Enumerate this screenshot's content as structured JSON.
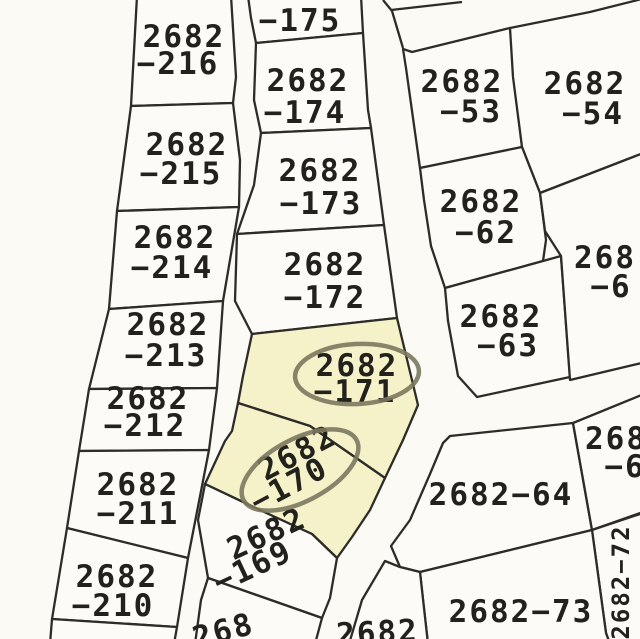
{
  "map": {
    "title": "cadastral-parcel-map",
    "canvas": {
      "width": 640,
      "height": 639
    },
    "colors": {
      "paper": "#fbfaf5",
      "parcel_fill": "#fcfbf7",
      "highlight_fill": "#f5f2ca",
      "line_color": "#2d2c26",
      "text_color": "#22211c",
      "ellipse_color": "#7b785e"
    },
    "style": {
      "line_width": 2.3,
      "font_size": 31,
      "ellipse_width": 4.5
    },
    "parcels": [
      {
        "id": "2682-216",
        "highlight": false,
        "points": [
          [
            137,
            -4
          ],
          [
            231,
            -4
          ],
          [
            236,
            77
          ],
          [
            233,
            103
          ],
          [
            131,
            106
          ]
        ],
        "label": {
          "lines": [
            {
              "t": "2682",
              "x": 184,
              "y": 47,
              "r": 0
            },
            {
              "t": "−216",
              "x": 178,
              "y": 74,
              "r": 0
            }
          ]
        }
      },
      {
        "id": "2682-215",
        "highlight": false,
        "points": [
          [
            131,
            106
          ],
          [
            233,
            103
          ],
          [
            240,
            160
          ],
          [
            239,
            207
          ],
          [
            117,
            211
          ]
        ],
        "label": {
          "lines": [
            {
              "t": "2682",
              "x": 187,
              "y": 155,
              "r": 0
            },
            {
              "t": "−215",
              "x": 181,
              "y": 184,
              "r": 0
            }
          ]
        }
      },
      {
        "id": "2682-214",
        "highlight": false,
        "points": [
          [
            117,
            211
          ],
          [
            239,
            207
          ],
          [
            223,
            301
          ],
          [
            109,
            309
          ]
        ],
        "label": {
          "lines": [
            {
              "t": "2682",
              "x": 175,
              "y": 248,
              "r": 0
            },
            {
              "t": "−214",
              "x": 172,
              "y": 278,
              "r": 0
            }
          ]
        }
      },
      {
        "id": "2682-213",
        "highlight": false,
        "points": [
          [
            109,
            309
          ],
          [
            223,
            301
          ],
          [
            217,
            388
          ],
          [
            89,
            389
          ]
        ],
        "label": {
          "lines": [
            {
              "t": "2682",
              "x": 168,
              "y": 335,
              "r": 0
            },
            {
              "t": "−213",
              "x": 166,
              "y": 366,
              "r": 0
            }
          ]
        }
      },
      {
        "id": "2682-212",
        "highlight": false,
        "points": [
          [
            89,
            389
          ],
          [
            217,
            388
          ],
          [
            209,
            450
          ],
          [
            79,
            451
          ]
        ],
        "label": {
          "lines": [
            {
              "t": "2682",
              "x": 148,
              "y": 409,
              "r": 0
            },
            {
              "t": "−212",
              "x": 145,
              "y": 436,
              "r": 0
            }
          ]
        }
      },
      {
        "id": "2682-211",
        "highlight": false,
        "points": [
          [
            79,
            451
          ],
          [
            209,
            450
          ],
          [
            188,
            558
          ],
          [
            67,
            528
          ]
        ],
        "label": {
          "lines": [
            {
              "t": "2682",
              "x": 138,
              "y": 495,
              "r": 0
            },
            {
              "t": "−211",
              "x": 138,
              "y": 524,
              "r": 0
            }
          ]
        }
      },
      {
        "id": "2682-210",
        "highlight": false,
        "points": [
          [
            67,
            528
          ],
          [
            188,
            558
          ],
          [
            177,
            627
          ],
          [
            52,
            619
          ]
        ],
        "label": {
          "lines": [
            {
              "t": "2682",
              "x": 117,
              "y": 587,
              "r": 0
            },
            {
              "t": "−210",
              "x": 113,
              "y": 616,
              "r": 0
            }
          ]
        }
      },
      {
        "id": "sliver-below-210",
        "highlight": false,
        "points": [
          [
            52,
            619
          ],
          [
            177,
            627
          ],
          [
            174,
            644
          ],
          [
            50,
            644
          ]
        ],
        "label": {
          "lines": []
        }
      },
      {
        "id": "2682-175",
        "highlight": false,
        "points": [
          [
            248,
            -4
          ],
          [
            361,
            -4
          ],
          [
            363,
            33
          ],
          [
            256,
            43
          ],
          [
            251,
            18
          ]
        ],
        "label": {
          "lines": [
            {
              "t": "−175",
              "x": 300,
              "y": 31,
              "r": 0
            }
          ]
        }
      },
      {
        "id": "2682-174",
        "highlight": false,
        "points": [
          [
            256,
            43
          ],
          [
            363,
            33
          ],
          [
            368,
            110
          ],
          [
            371,
            128
          ],
          [
            261,
            133
          ],
          [
            254,
            100
          ]
        ],
        "label": {
          "lines": [
            {
              "t": "2682",
              "x": 308,
              "y": 91,
              "r": 0
            },
            {
              "t": "−174",
              "x": 305,
              "y": 123,
              "r": 0
            }
          ]
        }
      },
      {
        "id": "2682-173",
        "highlight": false,
        "points": [
          [
            261,
            133
          ],
          [
            371,
            128
          ],
          [
            384,
            225
          ],
          [
            237,
            234
          ],
          [
            254,
            185
          ]
        ],
        "label": {
          "lines": [
            {
              "t": "2682",
              "x": 320,
              "y": 181,
              "r": 0
            },
            {
              "t": "−173",
              "x": 321,
              "y": 214,
              "r": 0
            }
          ]
        }
      },
      {
        "id": "2682-172",
        "highlight": false,
        "points": [
          [
            237,
            234
          ],
          [
            384,
            225
          ],
          [
            397,
            318
          ],
          [
            252,
            334
          ],
          [
            235,
            301
          ]
        ],
        "label": {
          "lines": [
            {
              "t": "2682",
              "x": 325,
              "y": 275,
              "r": 0
            },
            {
              "t": "−172",
              "x": 325,
              "y": 308,
              "r": 0
            }
          ]
        }
      },
      {
        "id": "2682-171",
        "highlight": true,
        "points": [
          [
            252,
            334
          ],
          [
            397,
            318
          ],
          [
            418,
            405
          ],
          [
            403,
            440
          ],
          [
            385,
            478
          ],
          [
            310,
            426
          ],
          [
            238,
            403
          ],
          [
            243,
            376
          ]
        ],
        "label": {
          "lines": [
            {
              "t": "2682",
              "x": 357,
              "y": 376,
              "r": 0
            },
            {
              "t": "−171",
              "x": 355,
              "y": 402,
              "r": 0
            }
          ]
        }
      },
      {
        "id": "2682-170",
        "highlight": true,
        "points": [
          [
            238,
            403
          ],
          [
            310,
            426
          ],
          [
            385,
            478
          ],
          [
            370,
            510
          ],
          [
            352,
            537
          ],
          [
            337,
            558
          ],
          [
            312,
            534
          ],
          [
            262,
            511
          ],
          [
            205,
            484
          ],
          [
            225,
            441
          ],
          [
            232,
            431
          ]
        ],
        "label": {
          "lines": [
            {
              "t": "2682",
              "x": 302,
              "y": 462,
              "r": -28
            },
            {
              "t": "−170",
              "x": 294,
              "y": 494,
              "r": -28
            }
          ]
        }
      },
      {
        "id": "2682-169",
        "highlight": false,
        "points": [
          [
            205,
            484
          ],
          [
            262,
            511
          ],
          [
            312,
            534
          ],
          [
            337,
            558
          ],
          [
            330,
            598
          ],
          [
            322,
            618
          ],
          [
            208,
            578
          ],
          [
            198,
            520
          ]
        ],
        "label": {
          "lines": [
            {
              "t": "2682",
              "x": 271,
              "y": 543,
              "r": -25
            },
            {
              "t": "−169",
              "x": 257,
              "y": 576,
              "r": -25
            }
          ]
        }
      },
      {
        "id": "268-partial-bottom-left",
        "highlight": false,
        "points": [
          [
            208,
            578
          ],
          [
            322,
            618
          ],
          [
            315,
            644
          ],
          [
            195,
            644
          ],
          [
            201,
            600
          ]
        ],
        "label": {
          "lines": [
            {
              "t": "268",
              "x": 226,
              "y": 641,
              "r": -15
            }
          ]
        }
      },
      {
        "id": "2682-53",
        "highlight": false,
        "points": [
          [
            406,
            68
          ],
          [
            403,
            49
          ],
          [
            412,
            52
          ],
          [
            510,
            28
          ],
          [
            522,
            147
          ],
          [
            420,
            168
          ]
        ],
        "label": {
          "lines": [
            {
              "t": "2682",
              "x": 462,
              "y": 92,
              "r": 0
            },
            {
              "t": "−53",
              "x": 471,
              "y": 122,
              "r": 0
            }
          ]
        }
      },
      {
        "id": "2682-54",
        "highlight": false,
        "points": [
          [
            510,
            28
          ],
          [
            590,
            12
          ],
          [
            646,
            -2
          ],
          [
            646,
            152
          ],
          [
            540,
            193
          ],
          [
            522,
            147
          ],
          [
            513,
            77
          ]
        ],
        "label": {
          "lines": [
            {
              "t": "2682",
              "x": 585,
              "y": 94,
              "r": 0
            },
            {
              "t": "−54",
              "x": 593,
              "y": 124,
              "r": 0
            }
          ]
        }
      },
      {
        "id": "2682-62",
        "highlight": false,
        "points": [
          [
            420,
            168
          ],
          [
            522,
            147
          ],
          [
            540,
            193
          ],
          [
            546,
            240
          ],
          [
            543,
            261
          ],
          [
            445,
            288
          ],
          [
            431,
            246
          ],
          [
            424,
            200
          ]
        ],
        "label": {
          "lines": [
            {
              "t": "2682",
              "x": 481,
              "y": 212,
              "r": 0
            },
            {
              "t": "−62",
              "x": 486,
              "y": 243,
              "r": 0
            }
          ]
        }
      },
      {
        "id": "2682-63",
        "highlight": false,
        "points": [
          [
            445,
            288
          ],
          [
            543,
            261
          ],
          [
            561,
            256
          ],
          [
            570,
            377
          ],
          [
            477,
            397
          ],
          [
            458,
            376
          ],
          [
            448,
            321
          ]
        ],
        "label": {
          "lines": [
            {
              "t": "2682",
              "x": 501,
              "y": 327,
              "r": 0
            },
            {
              "t": "−63",
              "x": 508,
              "y": 356,
              "r": 0
            }
          ]
        }
      },
      {
        "id": "268-6-upper",
        "highlight": false,
        "points": [
          [
            540,
            193
          ],
          [
            646,
            152
          ],
          [
            646,
            362
          ],
          [
            570,
            380
          ],
          [
            561,
            256
          ],
          [
            545,
            231
          ]
        ],
        "label": {
          "lines": [
            {
              "t": "268",
              "x": 605,
              "y": 268,
              "r": 0
            },
            {
              "t": "−6",
              "x": 611,
              "y": 297,
              "r": 0
            }
          ]
        }
      },
      {
        "id": "2682-64",
        "highlight": false,
        "points": [
          [
            450,
            436
          ],
          [
            573,
            423
          ],
          [
            592,
            530
          ],
          [
            420,
            572
          ],
          [
            400,
            567
          ],
          [
            391,
            546
          ],
          [
            410,
            520
          ],
          [
            430,
            474
          ],
          [
            443,
            443
          ]
        ],
        "label": {
          "lines": [
            {
              "t": "2682−64",
              "x": 501,
              "y": 505,
              "r": 0
            }
          ]
        }
      },
      {
        "id": "268-6-lower",
        "highlight": false,
        "points": [
          [
            573,
            423
          ],
          [
            644,
            394
          ],
          [
            646,
            511
          ],
          [
            592,
            530
          ]
        ],
        "label": {
          "lines": [
            {
              "t": "268",
              "x": 616,
              "y": 449,
              "r": 0
            },
            {
              "t": "−6",
              "x": 625,
              "y": 477,
              "r": 0
            }
          ]
        }
      },
      {
        "id": "2682-72",
        "highlight": false,
        "points": [
          [
            592,
            530
          ],
          [
            646,
            512
          ],
          [
            646,
            644
          ],
          [
            610,
            644
          ],
          [
            606,
            633
          ]
        ],
        "label": {
          "lines": [
            {
              "t": "2682−72",
              "x": 629,
              "y": 582,
              "r": -90,
              "s": 24
            }
          ]
        }
      },
      {
        "id": "2682-73",
        "highlight": false,
        "points": [
          [
            420,
            572
          ],
          [
            592,
            530
          ],
          [
            606,
            633
          ],
          [
            610,
            644
          ],
          [
            428,
            644
          ],
          [
            423,
            600
          ]
        ],
        "label": {
          "lines": [
            {
              "t": "2682−73",
              "x": 521,
              "y": 622,
              "r": 0
            }
          ]
        }
      },
      {
        "id": "2682-partial-bottom-center",
        "highlight": false,
        "points": [
          [
            385,
            561
          ],
          [
            400,
            567
          ],
          [
            420,
            572
          ],
          [
            428,
            644
          ],
          [
            349,
            644
          ],
          [
            362,
            600
          ]
        ],
        "label": {
          "lines": [
            {
              "t": "2682",
              "x": 378,
              "y": 643,
              "r": -3
            }
          ]
        }
      }
    ],
    "extra_lines": [
      {
        "name": "road-edge-top-right-branch",
        "points": [
          [
            391,
            10
          ],
          [
            462,
            2
          ]
        ]
      },
      {
        "name": "road-edge-top-fork",
        "points": [
          [
            383,
            0
          ],
          [
            392,
            11
          ],
          [
            403,
            48
          ]
        ]
      }
    ],
    "ellipses": [
      {
        "parcel": "2682-171",
        "cx": 357,
        "cy": 374,
        "rx": 62,
        "ry": 30,
        "rot": -3
      },
      {
        "parcel": "2682-170",
        "cx": 300,
        "cy": 470,
        "rx": 64,
        "ry": 31,
        "rot": -28
      }
    ]
  }
}
